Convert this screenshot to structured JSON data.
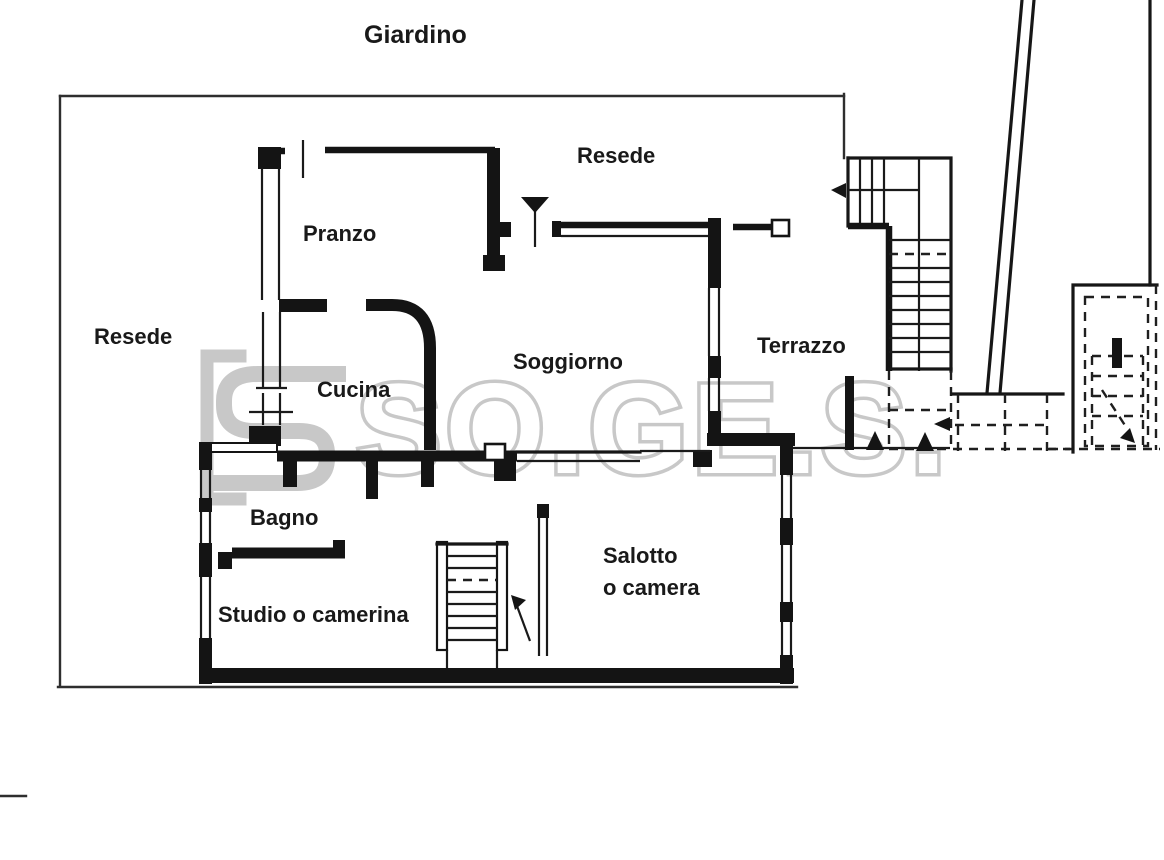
{
  "document": {
    "type": "floor-plan",
    "description": "Scanned Italian apartment floor plan with garden"
  },
  "watermark": {
    "text": "SO.GE.S.",
    "color": "#c8c8c8"
  },
  "colors": {
    "wall_line": "#141414",
    "boundary_line": "#2e2e2e",
    "background": "#ffffff"
  },
  "labels": [
    {
      "id": "giardino",
      "text": "Giardino",
      "x": 364,
      "y": 21,
      "size": 25
    },
    {
      "id": "resede-top",
      "text": "Resede",
      "x": 577,
      "y": 143,
      "size": 22
    },
    {
      "id": "resede-left",
      "text": "Resede",
      "x": 94,
      "y": 324,
      "size": 22
    },
    {
      "id": "pranzo",
      "text": "Pranzo",
      "x": 303,
      "y": 221,
      "size": 22
    },
    {
      "id": "cucina",
      "text": "Cucina",
      "x": 317,
      "y": 377,
      "size": 22
    },
    {
      "id": "soggiorno",
      "text": "Soggiorno",
      "x": 513,
      "y": 349,
      "size": 22
    },
    {
      "id": "terrazzo",
      "text": "Terrazzo",
      "x": 757,
      "y": 333,
      "size": 22
    },
    {
      "id": "bagno",
      "text": "Bagno",
      "x": 250,
      "y": 505,
      "size": 22
    },
    {
      "id": "studio-o-camerina",
      "text": "Studio o camerina",
      "x": 218,
      "y": 602,
      "size": 22
    },
    {
      "id": "salotto-line1",
      "text": "Salotto",
      "x": 603,
      "y": 543,
      "size": 22
    },
    {
      "id": "salotto-line2",
      "text": "o camera",
      "x": 603,
      "y": 575,
      "size": 22
    }
  ]
}
